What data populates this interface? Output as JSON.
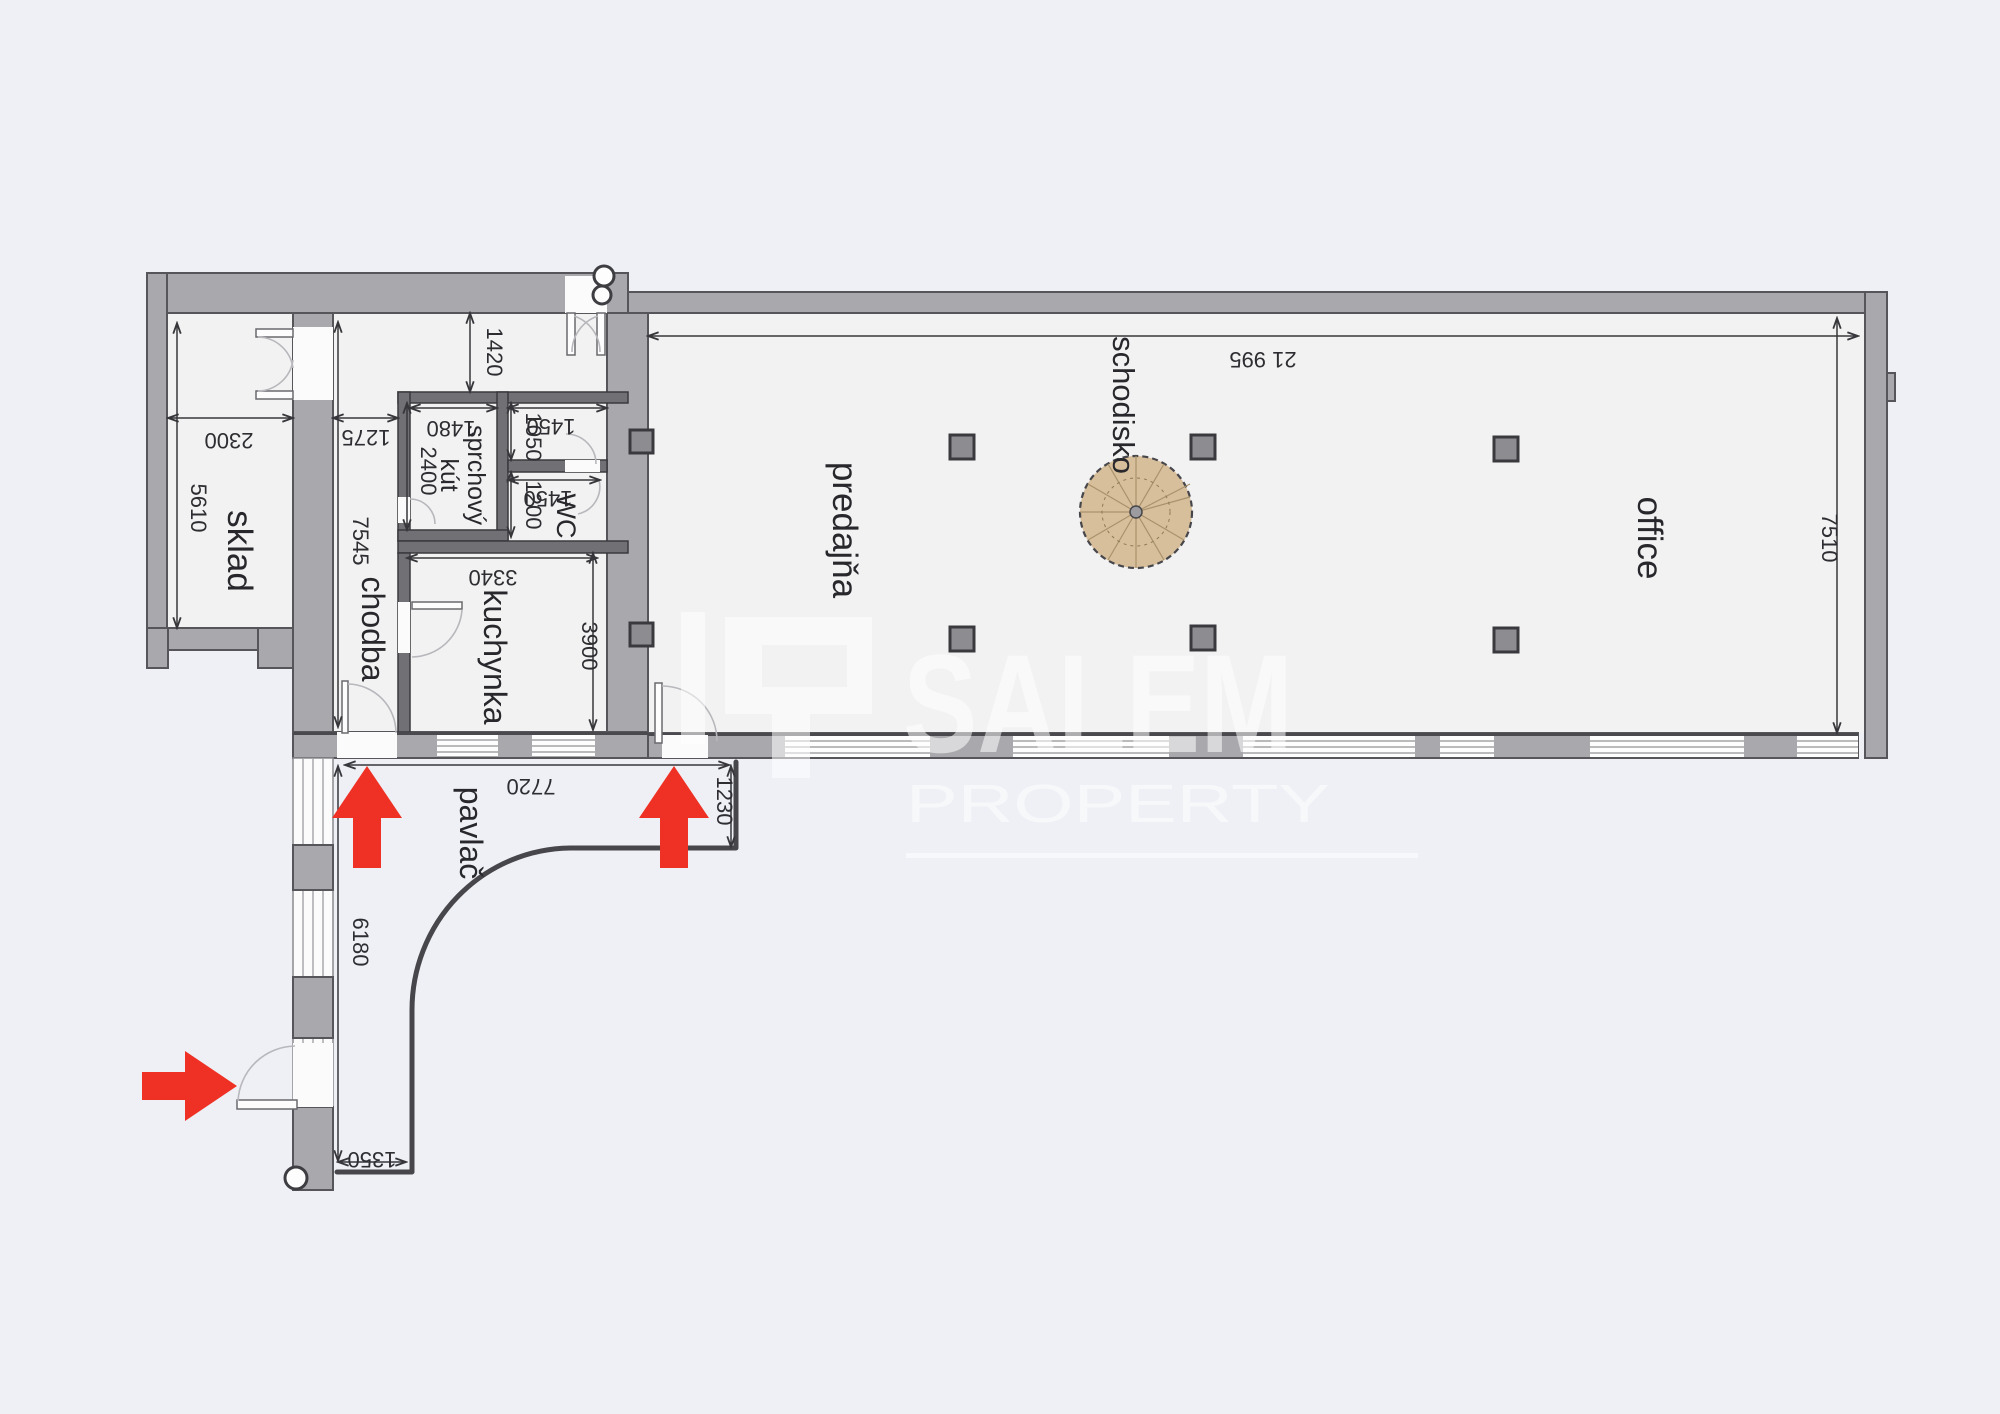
{
  "document": {
    "type": "architectural floor plan",
    "language": "Slovak"
  },
  "watermark": {
    "brand": "SALEM",
    "subtitle": "PROPERTY"
  },
  "rooms": {
    "sklad": "sklad",
    "chodba": "chodba",
    "sprchovy_kut": {
      "line1": "sprchový",
      "line2": "kút"
    },
    "wc": "WC",
    "kuchynka": "kuchynka",
    "predajna": "predajňa",
    "schodisko": "schodisko",
    "office": "office",
    "pavlac": "pavlač"
  },
  "dimensions_mm": {
    "sklad_width": "2300",
    "sklad_depth": "5610",
    "chodba_width": "1275",
    "chodba_depth": "7545",
    "entry_passage": "1420",
    "shower_width": "1480",
    "shower_depth": "2400",
    "anteroom_width": "1450",
    "anteroom_depth": "1050",
    "wc_width": "1450",
    "wc_depth": "1200",
    "kitchen_width": "3340",
    "kitchen_depth": "3900",
    "hall_length": "21 995",
    "hall_depth": "7510",
    "pavlac_top_width": "7720",
    "pavlac_entry_width": "1230",
    "pavlac_side_length": "6180",
    "pavlac_bottom_width": "1350"
  },
  "icons": {
    "entrance_arrows": [
      "up",
      "up",
      "right"
    ],
    "spiral_staircase": "spiral-stair",
    "column_count": 8
  },
  "colors": {
    "background": "#eef0f6",
    "floor": "#f2f2f3",
    "wall": "#a9a9ad",
    "partition_wall": "#707075",
    "outline": "#55555a",
    "dimension_text": "#2e2e32",
    "arrow_red": "#ee3124",
    "stair_wood": "#d8bf9b",
    "watermark_white": "#ffffff"
  }
}
